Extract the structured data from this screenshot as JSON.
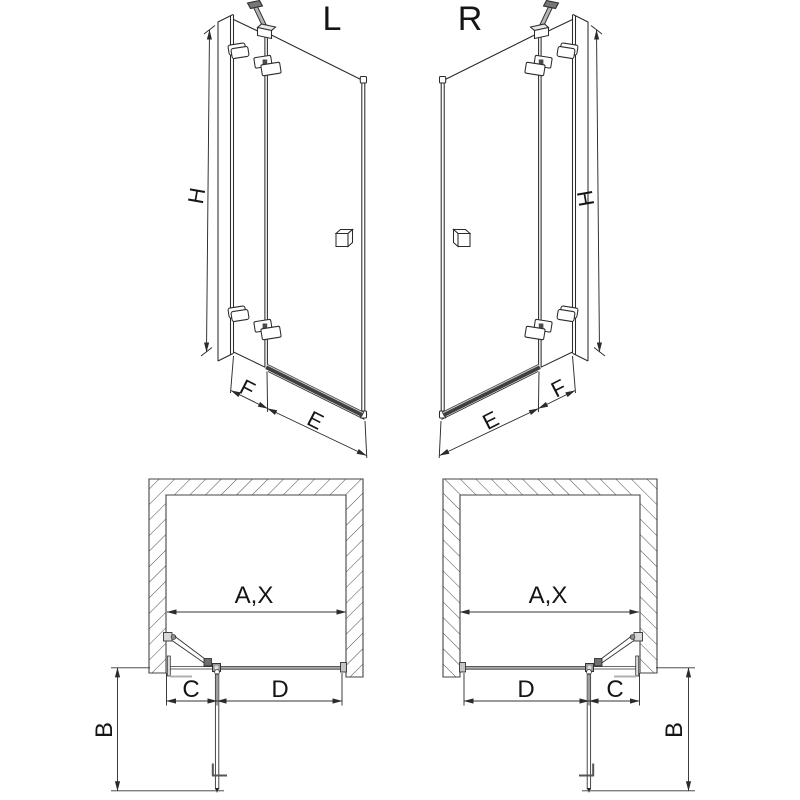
{
  "diagram": {
    "title_left": "L",
    "title_right": "R",
    "dims": {
      "height": "H",
      "fixed_bottom": "F",
      "door_bottom": "E",
      "opening": "A,X",
      "fixed_plan": "C",
      "door_plan": "D",
      "depth": "B"
    },
    "colors": {
      "line": "#2b2b2b",
      "plan_line": "#333333",
      "rail": "#3f3f3f",
      "metal_fill": "#b5b5b5",
      "hatch": "#4a4a4a",
      "background": "#ffffff"
    }
  }
}
